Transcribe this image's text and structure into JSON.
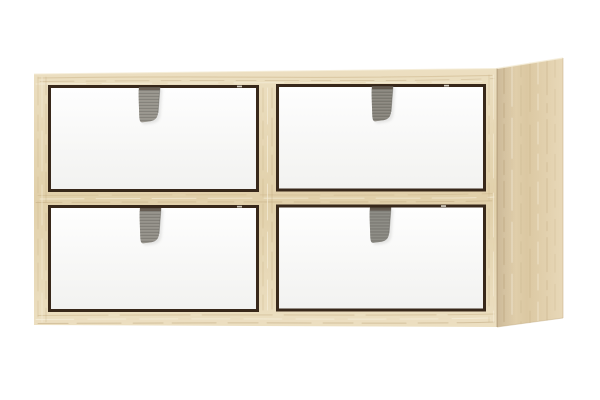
{
  "scene": {
    "kind": "product-photo",
    "subject": "Wall cabinet with four white drawers and grey fabric pull tabs",
    "cabinet": {
      "material": "light-oak-woodgrain",
      "rows": 2,
      "columns": 2
    },
    "drawers": [
      {
        "position": "top-left",
        "tab": "grey-fabric-loop",
        "tab_color": "#98958d"
      },
      {
        "position": "top-right",
        "tab": "grey-fabric-loop",
        "tab_color": "#85827a"
      },
      {
        "position": "bottom-left",
        "tab": "grey-fabric-loop",
        "tab_color": "#928f88"
      },
      {
        "position": "bottom-right",
        "tab": "grey-fabric-loop",
        "tab_color": "#878680"
      }
    ]
  },
  "colors": {
    "background": "#ffffff",
    "wood_highlight": "#f5edd9",
    "wood_light": "#ecdfc1",
    "wood_mid": "#e1d0aa",
    "wood_dark": "#cbb489",
    "wood_streak": "#b89e73",
    "side_light": "#e8d8b8",
    "side_mid": "#dbc8a2",
    "side_dark": "#c6af87",
    "corner_shade": "#8b704b",
    "gap_dark": "#38281a",
    "gap_glint": "#e9e3d7",
    "drawer_top": "#fefefe",
    "drawer_bottom": "#f2f2f0",
    "tab_rib_dark": "#6e6b64",
    "tab_rib_light": "#a5a29a",
    "tab_edge": "#64615b",
    "shadow": "#8f8f8c"
  }
}
